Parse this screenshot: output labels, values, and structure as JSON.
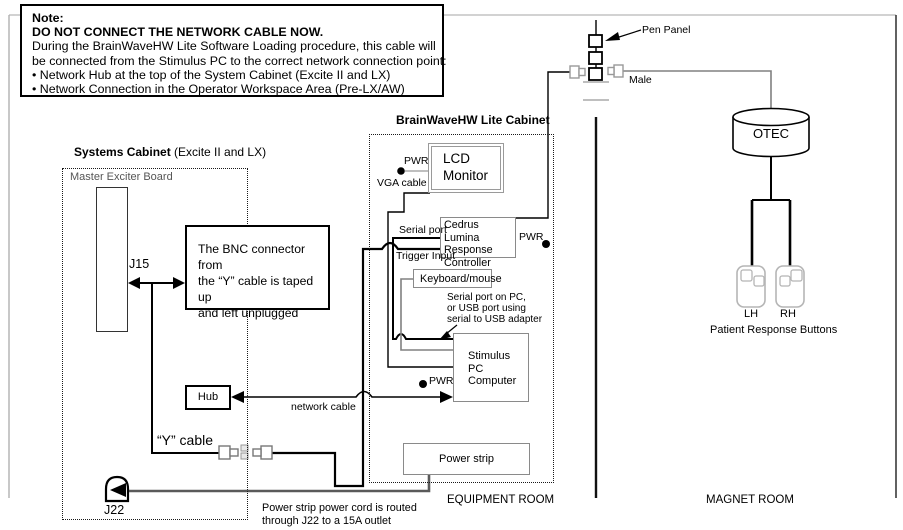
{
  "note": {
    "title": "Note:",
    "warning": "DO NOT CONNECT THE NETWORK CABLE NOW.",
    "body1": "During the BrainWaveHW Lite Software Loading procedure, this cable will",
    "body2": "be connected from the Stimulus PC to the correct network connection point:",
    "bullet1": "• Network Hub at the top of the System Cabinet (Excite II and LX)",
    "bullet2": "• Network Connection in the Operator Workspace Area (Pre-LX/AW)"
  },
  "systems_cabinet": {
    "title": "Systems Cabinet",
    "title_suffix": " (Excite II and LX)",
    "board_label": "Master Exciter Board",
    "j15": "J15",
    "bnc_note1": "The BNC connector from",
    "bnc_note2": "the “Y” cable is taped up",
    "bnc_note3": "and left unplugged",
    "hub": "Hub",
    "y_cable": "“Y” cable",
    "j22": "J22"
  },
  "lite_cabinet": {
    "title": "BrainWaveHW Lite Cabinet",
    "lcd1": "LCD",
    "lcd2": "Monitor",
    "pwr_monitor": "PWR",
    "vga_cable": "VGA cable",
    "serial_port": "Serial port",
    "trigger_input": "Trigger Input",
    "cedrus1": "Cedrus Lumina",
    "cedrus2": "Response",
    "cedrus3": "Controller",
    "pwr_cedrus": "PWR",
    "keyboard_mouse": "Keyboard/mouse",
    "serial_note1": "Serial port on PC,",
    "serial_note2": "or USB port using",
    "serial_note3": "serial to USB adapter",
    "stimulus1": "Stimulus",
    "stimulus2": "PC",
    "stimulus3": "Computer",
    "pwr_pc": "PWR",
    "network_cable": "network cable",
    "power_strip": "Power strip"
  },
  "magnet_side": {
    "pen_panel": "Pen Panel",
    "male": "Male",
    "otec": "OTEC",
    "lh": "LH",
    "rh": "RH",
    "patient_buttons": "Patient Response Buttons"
  },
  "rooms": {
    "equipment": "EQUIPMENT ROOM",
    "magnet": "MAGNET ROOM"
  },
  "footnote": {
    "line1": "Power strip power cord is routed",
    "line2": "through J22 to a 15A outlet"
  },
  "colors": {
    "line_black": "#000000",
    "line_gray": "#808080",
    "cord_gray": "#5a5a5a"
  }
}
